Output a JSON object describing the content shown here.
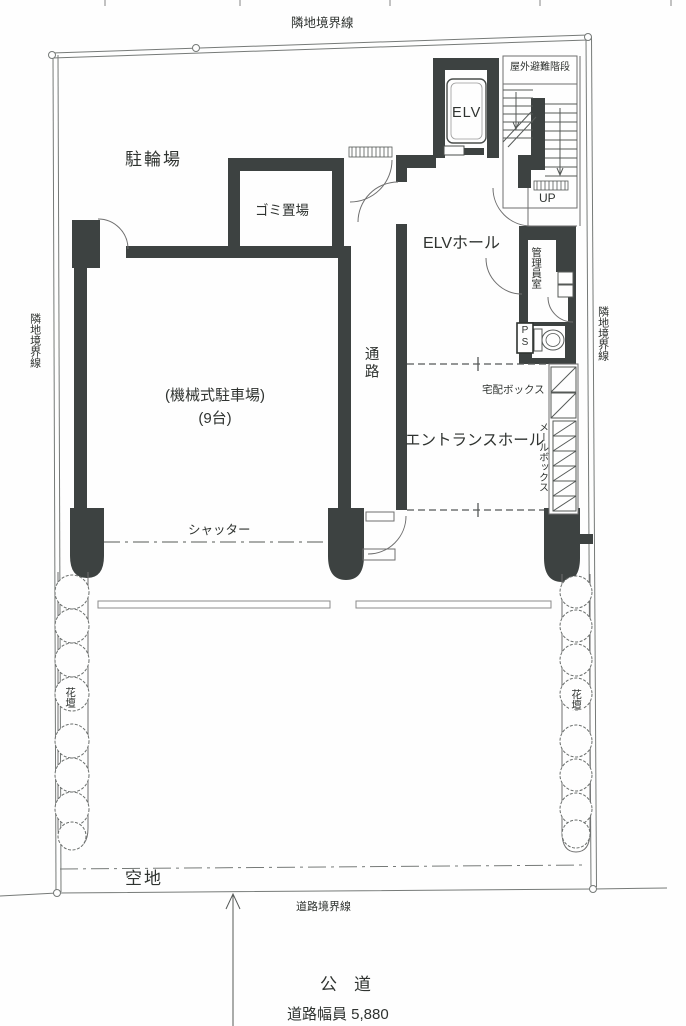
{
  "labels": {
    "boundary_top": "隣地境界線",
    "boundary_left": "隣地境界線",
    "boundary_right": "隣地境界線",
    "road_boundary": "道路境界線",
    "bicycle_parking": "駐輪場",
    "garbage_room": "ゴミ置場",
    "elevator": "ELV",
    "outdoor_stairs": "屋外避難階段",
    "up": "UP",
    "elv_hall": "ELVホール",
    "manager_room": "管理員室",
    "pipe_space": "PS",
    "corridor": "通路",
    "mech_parking": "(機械式駐車場)",
    "mech_parking_count": "(9台)",
    "delivery_box": "宅配ボックス",
    "entrance_hall": "エントランスホール",
    "mail_box": "メールボックス",
    "shutter": "シャッター",
    "flower_bed_left": "花壇",
    "flower_bed_right": "花壇",
    "vacant_lot": "空地",
    "public_road": "公　道",
    "road_width": "道路幅員 5,880"
  },
  "colors": {
    "wall": "#3d4241",
    "line": "#6f6f6f",
    "text": "#2f3330",
    "background": "#fefefe"
  }
}
